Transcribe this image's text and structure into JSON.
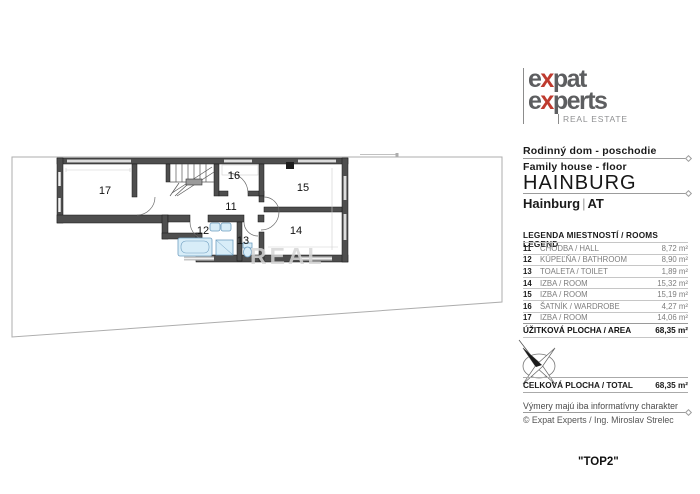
{
  "logo": {
    "l1_pre": "e",
    "l1_x": "x",
    "l1_post": "pat",
    "l2_pre": "e",
    "l2_x": "x",
    "l2_post": "perts",
    "tagline": "REAL ESTATE",
    "accent_color": "#bf3b2f",
    "gray_color": "#5d5e60"
  },
  "title_block": {
    "title_sk": "Rodinný dom - poschodie",
    "title_en": "Family house - floor",
    "city": "HAINBURG",
    "location": "Hainburg",
    "separator": "|",
    "country": "AT"
  },
  "legend": {
    "header": "LEGENDA MIESTNOSTÍ / ROOMS LEGEND",
    "rows": [
      {
        "number": "11",
        "name": "CHODBA / HALL",
        "area": "8,72 m²"
      },
      {
        "number": "12",
        "name": "KÚPEĽŇA / BATHROOM",
        "area": "8,90 m²"
      },
      {
        "number": "13",
        "name": "TOALETA / TOILET",
        "area": "1,89 m²"
      },
      {
        "number": "14",
        "name": "IZBA / ROOM",
        "area": "15,32 m²"
      },
      {
        "number": "15",
        "name": "IZBA / ROOM",
        "area": "15,19 m²"
      },
      {
        "number": "16",
        "name": "ŠATNÍK / WARDROBE",
        "area": "4,27 m²"
      },
      {
        "number": "17",
        "name": "IZBA / ROOM",
        "area": "14,06 m²"
      }
    ],
    "usable_label": "ÚŽITKOVÁ PLOCHA / AREA",
    "usable_value": "68,35 m²"
  },
  "totals": {
    "label": "CELKOVÁ PLOCHA / TOTAL",
    "value": "68,35 m²"
  },
  "footer": {
    "disclaimer": "Výmery majú iba informatívny charakter",
    "copyright": "© Expat Experts / Ing. Miroslav Strelec",
    "unit_label": "\"TOP2\""
  },
  "plan": {
    "rooms": [
      {
        "id": "17"
      },
      {
        "id": "16"
      },
      {
        "id": "15"
      },
      {
        "id": "11"
      },
      {
        "id": "12"
      },
      {
        "id": "13"
      },
      {
        "id": "14"
      }
    ],
    "watermark": "REAL",
    "wall_color": "#4e4e4e",
    "fixture_color": "#d8edf8",
    "boundary_color": "#adadad"
  }
}
